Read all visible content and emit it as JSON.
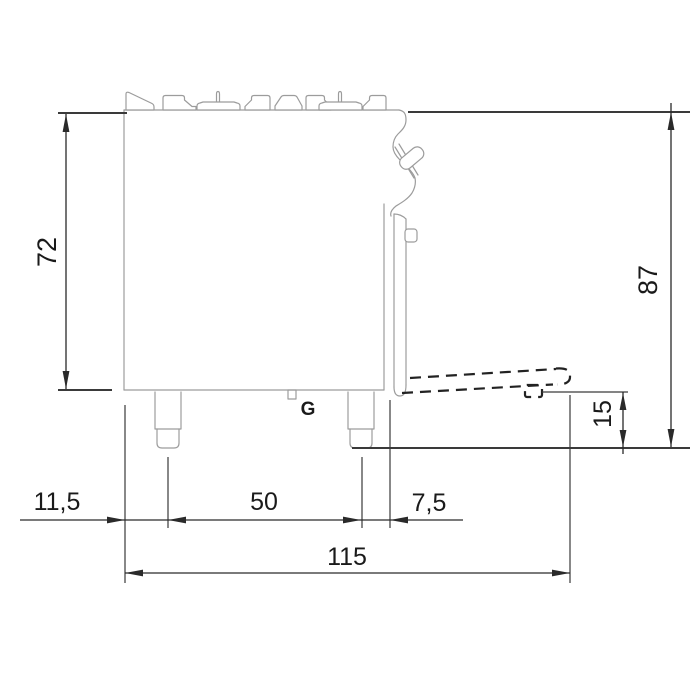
{
  "title": "Gas range side-view dimensional drawing",
  "labels": {
    "gas_connection": "G"
  },
  "dimensions": {
    "body_height": "72",
    "overall_height": "87",
    "base_height": "15",
    "left_edge_to_front_leg": "11,5",
    "leg_spacing": "50",
    "leg_to_front_panel": "7,5",
    "overall_depth_door_open": "115"
  },
  "colors": {
    "outline": "#9c9c9c",
    "dimension_line": "#2a2a2a",
    "text": "#1a1a1a",
    "background": "#ffffff"
  }
}
